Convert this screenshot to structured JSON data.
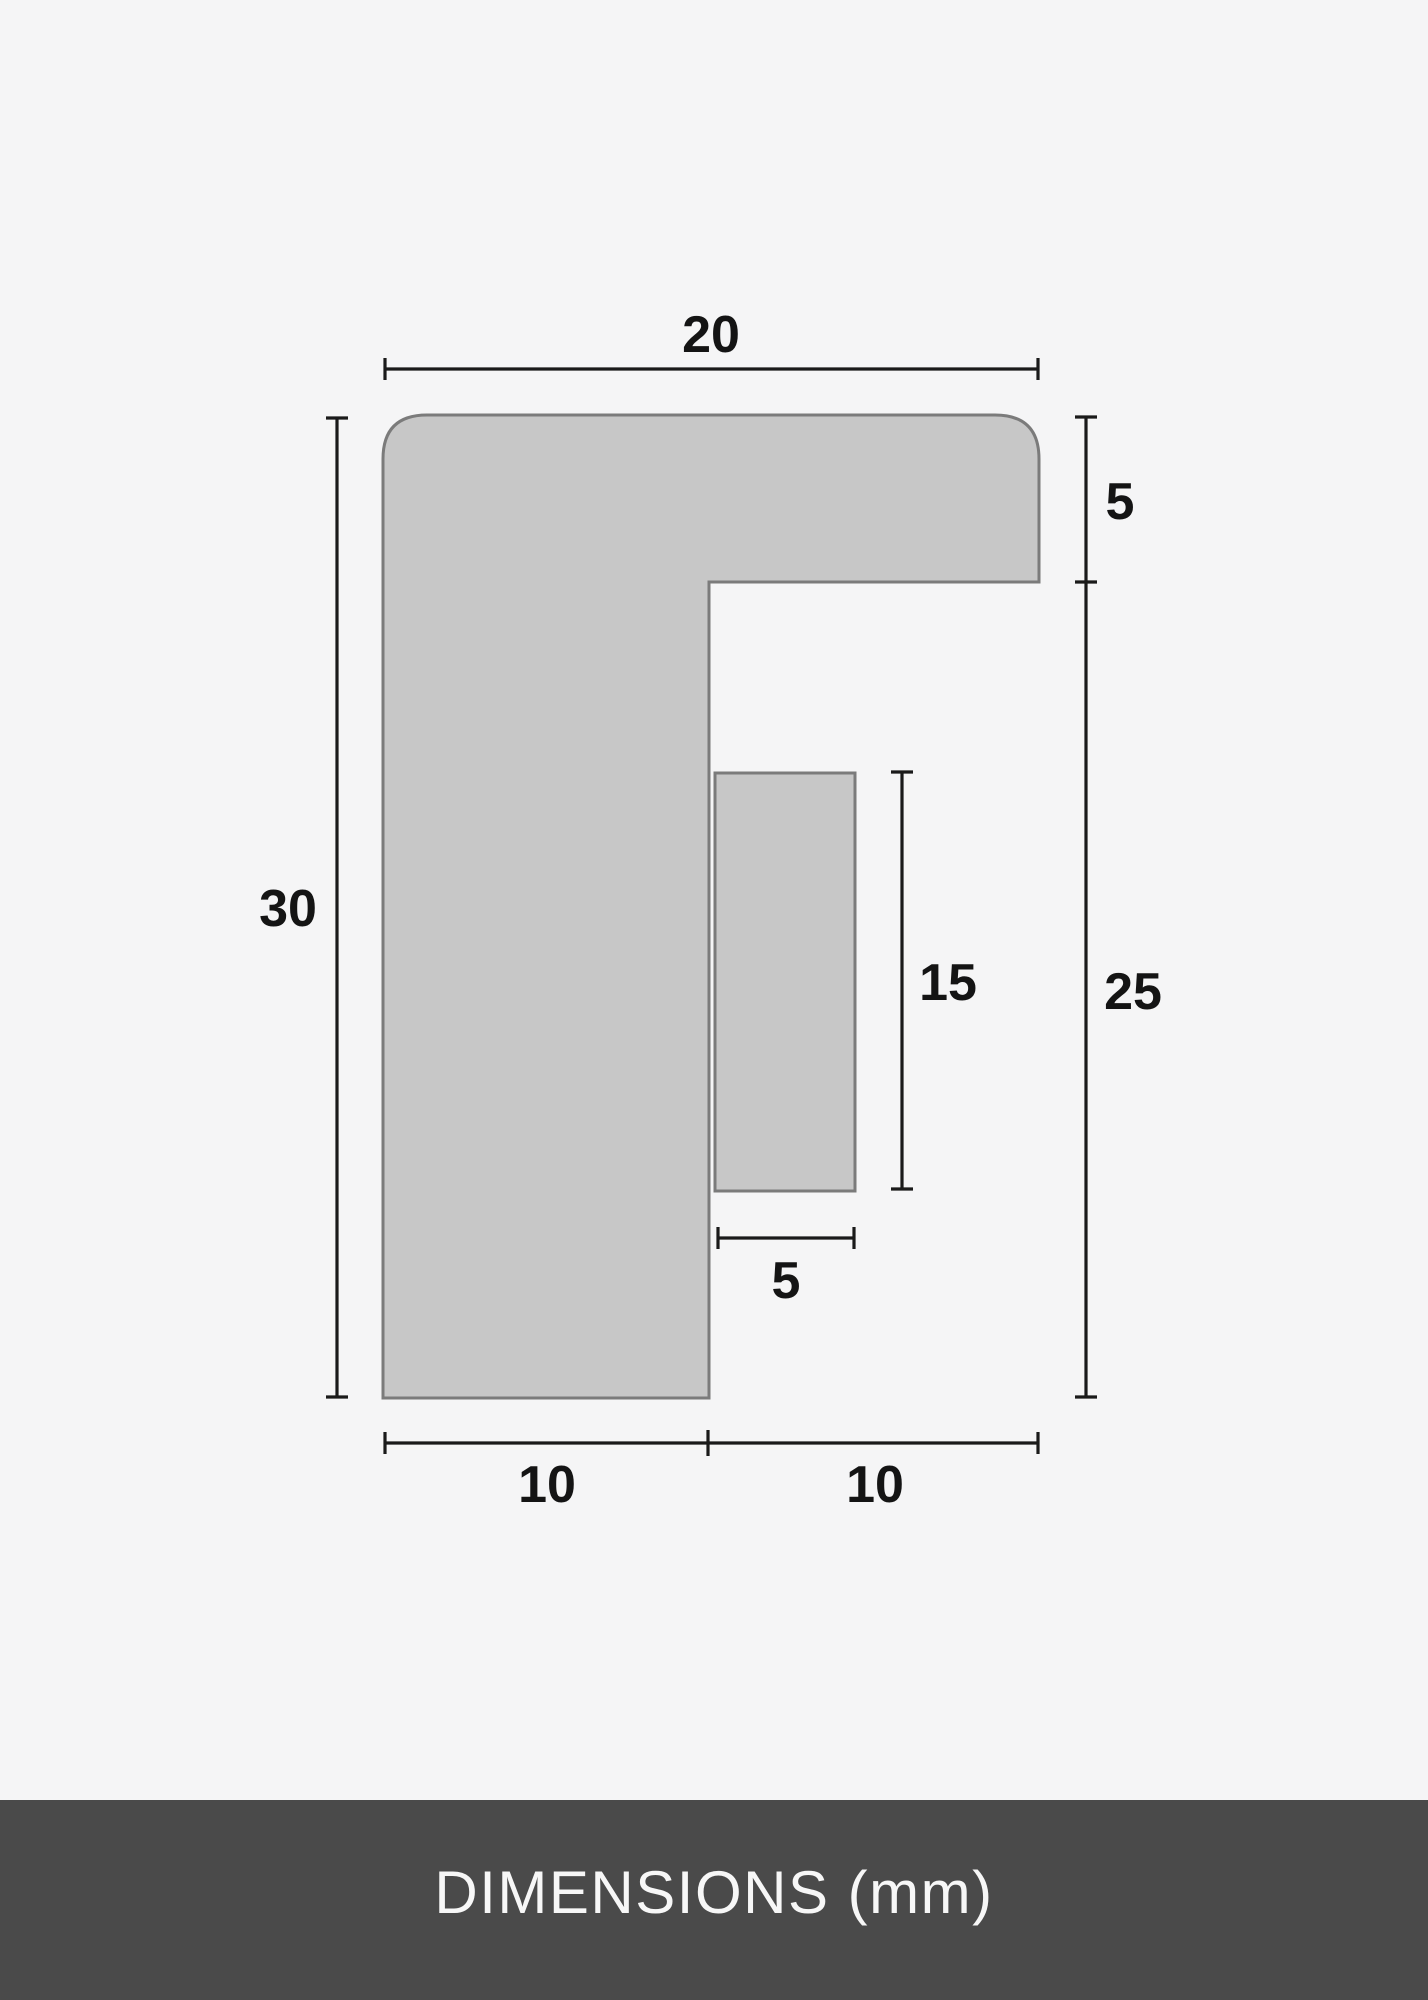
{
  "page": {
    "background_color": "#f5f5f6"
  },
  "diagram": {
    "type": "frame-profile-cross-section",
    "shape_fill_color": "#c7c7c7",
    "shape_stroke_color": "#7b7b7b",
    "dimension_line_color": "#1a1a1a",
    "dimensions": {
      "overall_width": "20",
      "top_arm_thickness": "5",
      "overall_height": "30",
      "right_side_height": "25",
      "lip_height": "15",
      "lip_width": "5",
      "bottom_left_width": "10",
      "bottom_right_width": "10"
    }
  },
  "footer": {
    "background_color": "#4a4a4a",
    "text_color": "#f7f7f7",
    "caption": "DIMENSIONS (mm)"
  }
}
